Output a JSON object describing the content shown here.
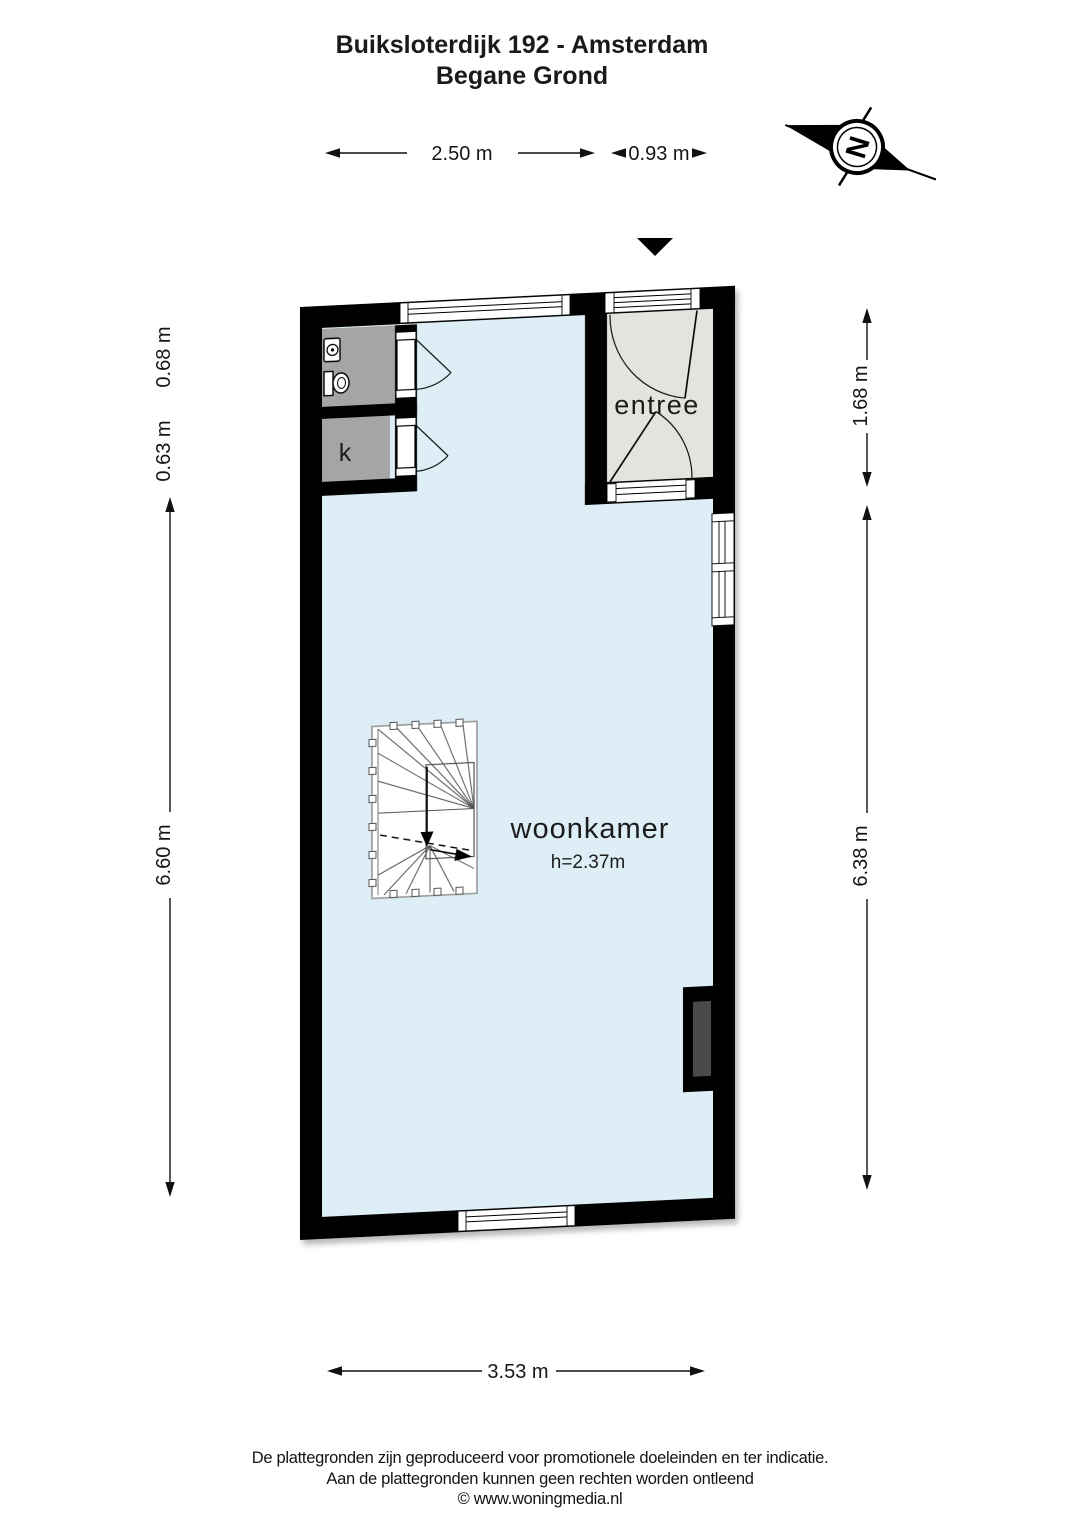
{
  "header": {
    "title_line1": "Buiksloterdijk 192 - Amsterdam",
    "title_line2": "Begane Grond"
  },
  "compass": {
    "north_label": "N"
  },
  "rooms": {
    "woonkamer": {
      "label": "woonkamer",
      "ceiling_height": "h=2.37m"
    },
    "entree": {
      "label": "entree"
    },
    "kast": {
      "label": "k"
    },
    "toilet": {
      "fixtures": [
        "toilet-icon",
        "sink-icon"
      ]
    }
  },
  "dimensions": {
    "top_width_main": "2.50 m",
    "top_width_entree": "0.93 m",
    "left_toilet_height": "0.68 m",
    "left_kast_height": "0.63 m",
    "left_room_height": "6.60 m",
    "right_entree_height": "1.68 m",
    "right_room_height": "6.38 m",
    "bottom_width": "3.53 m"
  },
  "colors": {
    "wall": "#000000",
    "woonkamer_floor": "#ddeef6",
    "entree_floor": "#e5e3de",
    "closet_floor": "#a5a5a5",
    "chimney_inset": "#4a4a4a",
    "stair_line": "#555555"
  },
  "footer": {
    "line1": "De plattegronden zijn geproduceerd voor promotionele doeleinden en ter indicatie.",
    "line2": "Aan de plattegronden kunnen geen rechten worden ontleend",
    "line3": "© www.woningmedia.nl"
  }
}
